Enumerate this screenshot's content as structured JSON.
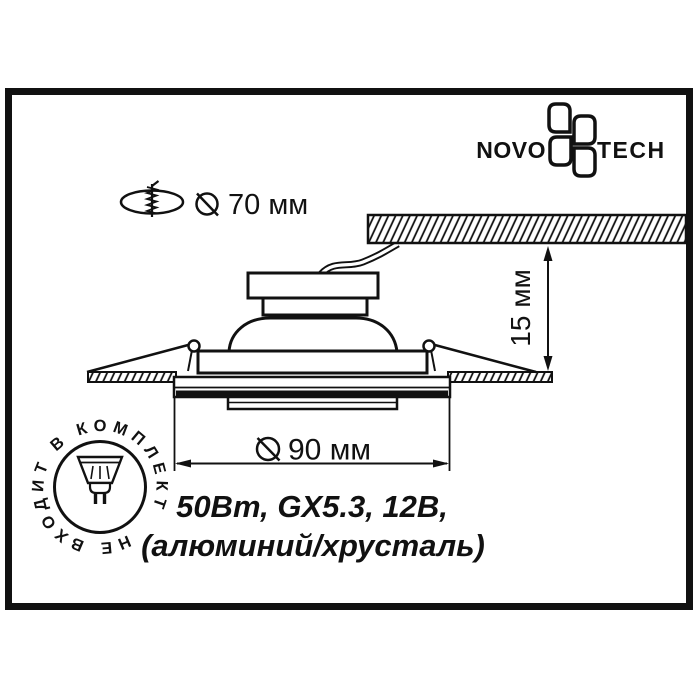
{
  "page": {
    "paper_color": "#ffffff",
    "ink_color": "#111111"
  },
  "brand": {
    "word_left": "NOVO",
    "word_right": "TECH",
    "icon": "flower-pinwheel-icon"
  },
  "annotations": {
    "cutout_label": "70 мм",
    "depth_label": "15 мм",
    "diameter_label": "90 мм",
    "cutout_icon": "drill-hole-icon",
    "diameter_symbol": "slashed-circle-diameter-icon"
  },
  "specs": {
    "line1": "50Вт, GX5.3, 12В,",
    "line2": "(алюминий/хрусталь)"
  },
  "stamp": {
    "text": "НЕ ВХОДИТ В КОМПЛЕКТ",
    "icon": "mr16-lamp-icon"
  }
}
